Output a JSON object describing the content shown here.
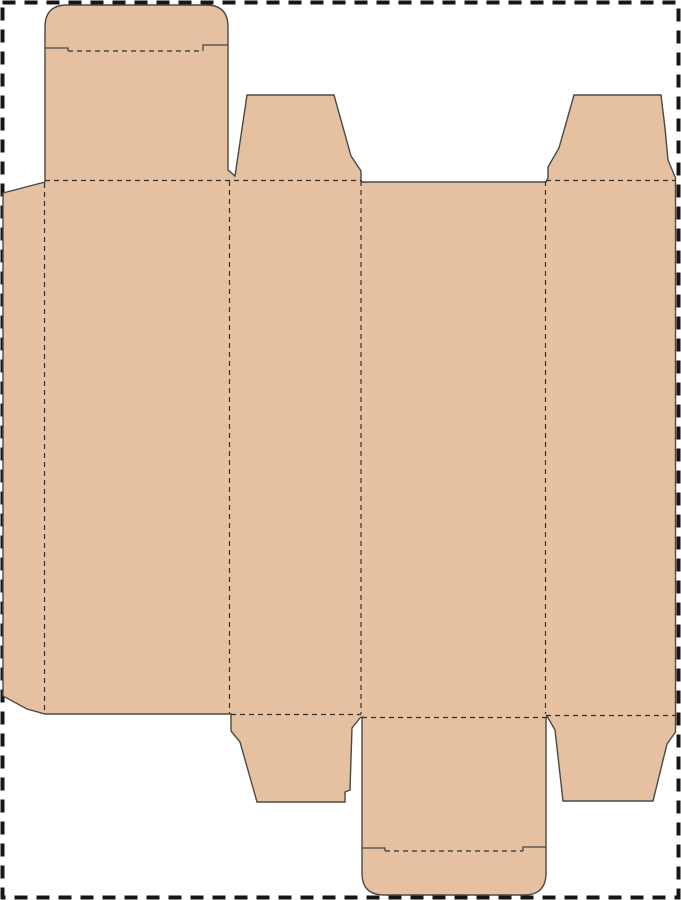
{
  "page": {
    "width": 681,
    "height": 900,
    "background_color": "#ffffff",
    "margin_border_color": "#161616"
  },
  "dieline": {
    "kind": "reverse-tuck-end-box-template",
    "fill_color": "#e6c1a1",
    "cut_line_color": "#4a4a44",
    "fold_line_color": "#33332f",
    "outline_path": "M 45,27 Q 45,5 67,5 L 206,5 Q 228,5 228,27 L 228,170 L 235,176 L 247,95 L 334,95 L 351,156 L 361,171 L 361,180 L 362,182 L 546,182 L 548,178 L 548,167 L 559,148 L 574,95 L 661,95 L 665,128 L 668,160 L 675.5,178 L 675.5,732 L 667,744 L 653,801 L 563,801 L 555,730 L 547,716 L 546,719 L 546,873 Q 546,895 524,895 L 384,895 Q 362,895 362,873 L 362,717 L 360,718 L 352,728 L 350,790 L 345,792 L 345,802 L 257,802 L 240,742 L 231,731 L 231,714 L 45,714 L 27,709 L 3,696 L 3,193 L 45,182 Z",
    "fold_lines": [
      "M 44.5,183 L 44.5,712",
      "M 229.5,181 L 229.5,713",
      "M 361,181 L 361,714",
      "M 545.5,181 L 545.5,714",
      "M 45,180.5 L 361,180.5",
      "M 546,180.5 L 675,180.5",
      "M 68,51 L 203,51",
      "M 231,714.5 L 361,714.5",
      "M 362,717.5 L 546,717.5",
      "M 546,715.5 L 675,715.5",
      "M 385,851 L 523,851"
    ],
    "cut_lines": [
      "M 45,48 L 68,48 L 68,51",
      "M 203,51 L 203,45 L 228,45",
      "M 362,848 L 385,848 L 385,851",
      "M 523,851 L 523,847 L 546,847"
    ]
  }
}
